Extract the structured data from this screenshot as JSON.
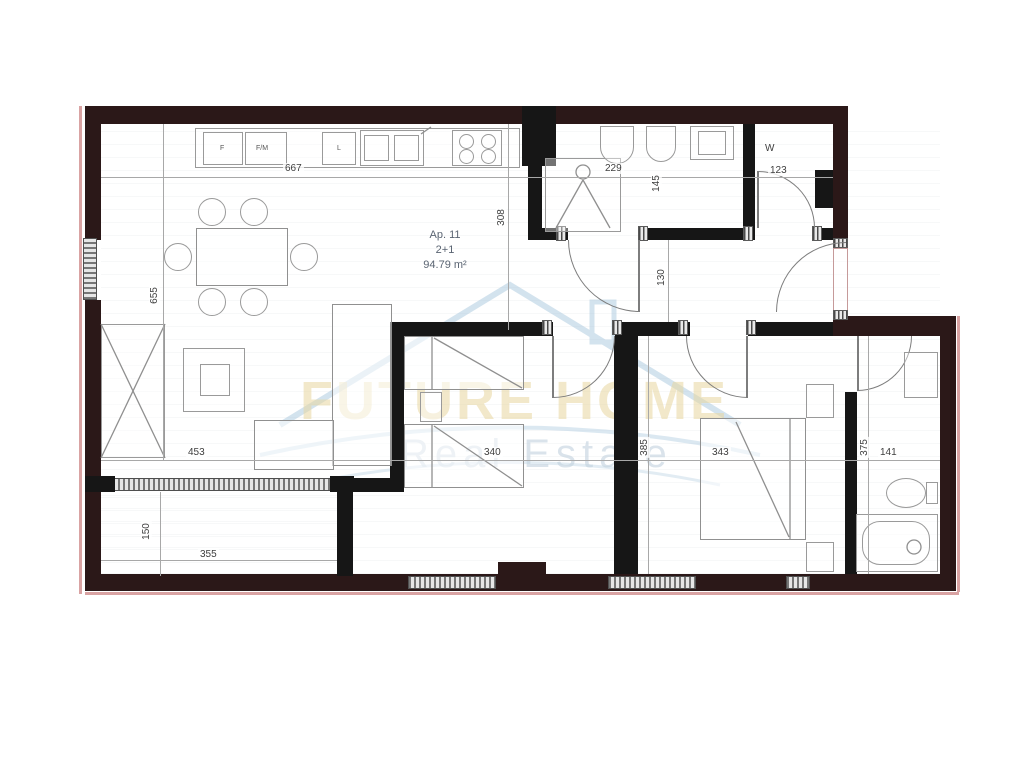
{
  "unit": {
    "name": "Ap. 11",
    "layout": "2+1",
    "area": "94.79 m²"
  },
  "watermark": {
    "title": "FUTURE HOME",
    "subtitle": "Real Estate"
  },
  "appliances": {
    "fridge": "F",
    "freezer": "F/M",
    "dishwasher": "L",
    "washer_room": "W"
  },
  "dims": {
    "kitchen_width": "667",
    "bath_width": "229",
    "bath_depth": "145",
    "wc_width": "123",
    "living_depth": "308",
    "living_height": "655",
    "hall_width": "130",
    "living_width": "453",
    "bedroom1_width": "340",
    "bedroom1_depth": "385",
    "bedroom2_width": "343",
    "ensuite_width": "141",
    "ensuite_depth": "375",
    "balcony_depth": "150",
    "balcony_width": "355"
  },
  "colors": {
    "wall_exterior": "#2b1818",
    "wall_interior": "#161616",
    "accent_pink": "#d9a3a3",
    "watermark_gold": "#e8d7a0",
    "watermark_blue": "#c2d2de"
  }
}
